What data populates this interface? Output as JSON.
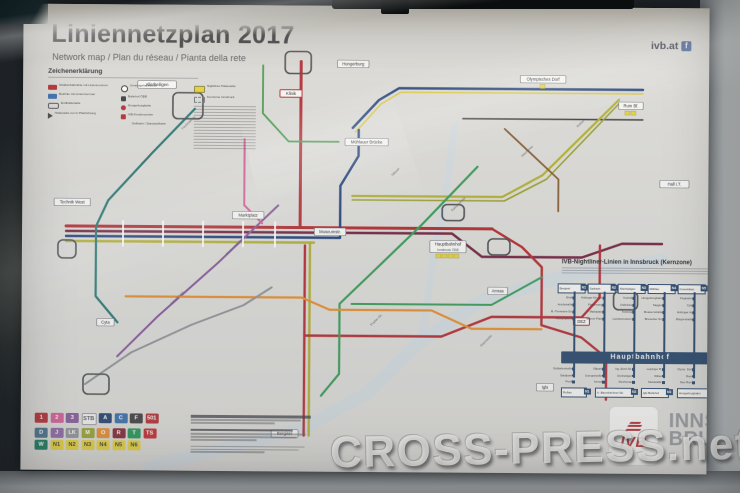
{
  "header": {
    "title": "Liniennetzplan 2017",
    "subtitle": "Network map / Plan du réseau / Pianta della rete",
    "site": "ivb.at",
    "facebook_label": "f"
  },
  "legend": {
    "title": "Zeichenerklärung",
    "columns": [
      [
        {
          "icon": "tram",
          "label": "Straßenbahnlinie mit Liniennummer"
        },
        {
          "icon": "bus",
          "label": "Buslinie mit Liniennummer"
        },
        {
          "icon": "loop",
          "label": "Endhaltestelle"
        },
        {
          "icon": "arrow",
          "label": "Haltestelle nur in Pfeilrichtung"
        }
      ],
      [
        {
          "icon": "hub",
          "label": "Umsteigehaltestelle"
        },
        {
          "icon": "rail",
          "label": "Bahnhof ÖBB"
        },
        {
          "icon": "funicular",
          "label": "Hungerburgbahn"
        },
        {
          "icon": "center",
          "label": "IVB-Kundencenter"
        },
        {
          "icon": "cable",
          "label": "Seilbahn / Standseilbahn"
        }
      ],
      [
        {
          "icon": "night",
          "label": "Nightliner-Haltestelle"
        },
        {
          "icon": "zone",
          "label": "Kernzone Innsbruck"
        }
      ]
    ]
  },
  "badge_grid": {
    "rows": [
      [
        {
          "t": "1",
          "bg": "#c0272d"
        },
        {
          "t": "2",
          "bg": "#e0589a"
        },
        {
          "t": "3",
          "bg": "#8a56a0"
        },
        {
          "t": "STB",
          "bg": "#f3f2ef",
          "fg": "#55555a",
          "border": true
        },
        {
          "t": "A",
          "bg": "#1d3f73"
        },
        {
          "t": "C",
          "bg": "#2f6db5"
        },
        {
          "t": "F",
          "bg": "#3d3d3f"
        },
        {
          "t": "501",
          "bg": "#c0272d"
        }
      ],
      [
        {
          "t": "D",
          "bg": "#3f6e8c"
        },
        {
          "t": "J",
          "bg": "#9064a8"
        },
        {
          "t": "LK",
          "bg": "#8f9398"
        },
        {
          "t": "M",
          "bg": "#97a31f"
        },
        {
          "t": "O",
          "bg": "#ef8b1f"
        },
        {
          "t": "R",
          "bg": "#8e2030"
        },
        {
          "t": "T",
          "bg": "#129a4e"
        },
        {
          "t": "TS",
          "bg": "#d2232a"
        }
      ],
      [
        {
          "t": "W",
          "bg": "#0a7a5a"
        },
        {
          "t": "N1",
          "bg": "#ead423",
          "fg": "#3a3a30"
        },
        {
          "t": "N2",
          "bg": "#ead423",
          "fg": "#3a3a30"
        },
        {
          "t": "N3",
          "bg": "#ead423",
          "fg": "#3a3a30"
        },
        {
          "t": "N4",
          "bg": "#ead423",
          "fg": "#3a3a30"
        },
        {
          "t": "N5",
          "bg": "#ead423",
          "fg": "#3a3a30"
        },
        {
          "t": "N6",
          "bg": "#ead423",
          "fg": "#3a3a30"
        }
      ]
    ]
  },
  "map": {
    "badge_color": "#ead423",
    "river": [
      {
        "c": "#c7dbe9",
        "w": 13,
        "o": 0.5,
        "pts": [
          [
            130,
            462
          ],
          [
            280,
            424
          ],
          [
            345,
            388
          ],
          [
            400,
            334
          ],
          [
            460,
            294
          ],
          [
            545,
            268
          ],
          [
            640,
            252
          ]
        ]
      },
      {
        "c": "#c7dbe9",
        "w": 7,
        "o": 0.45,
        "pts": [
          [
            400,
            334
          ],
          [
            412,
            250
          ],
          [
            425,
            175
          ],
          [
            432,
            120
          ]
        ]
      }
    ],
    "lines": [
      {
        "c": "#1c3f7e",
        "w": 2.4,
        "pts": [
          [
            330,
            122
          ],
          [
            356,
            94
          ],
          [
            376,
            82
          ],
          [
            620,
            82
          ]
        ]
      },
      {
        "c": "#ddc928",
        "w": 1.6,
        "pts": [
          [
            333,
            126
          ],
          [
            358,
            98
          ],
          [
            378,
            86
          ],
          [
            620,
            86
          ]
        ]
      },
      {
        "c": "#3a3a3a",
        "w": 1.4,
        "pts": [
          [
            440,
            112
          ],
          [
            620,
            112
          ]
        ]
      },
      {
        "c": "#c0272d",
        "w": 3,
        "pts": [
          [
            278,
            56
          ],
          [
            278,
            150
          ],
          [
            278,
            222
          ]
        ]
      },
      {
        "c": "#c0272d",
        "w": 3,
        "pts": [
          [
            44,
            222
          ],
          [
            470,
            222
          ]
        ]
      },
      {
        "c": "#7a2040",
        "w": 2.4,
        "pts": [
          [
            44,
            227
          ],
          [
            430,
            227
          ],
          [
            460,
            250
          ],
          [
            560,
            250
          ],
          [
            600,
            236
          ],
          [
            640,
            236
          ]
        ]
      },
      {
        "c": "#1c3f7e",
        "w": 2.4,
        "pts": [
          [
            44,
            232
          ],
          [
            318,
            232
          ],
          [
            318,
            180
          ],
          [
            336,
            150
          ],
          [
            336,
            124
          ]
        ]
      },
      {
        "c": "#b3b021",
        "w": 2.4,
        "pts": [
          [
            44,
            237
          ],
          [
            292,
            237
          ]
        ]
      },
      {
        "c": "#b3b021",
        "w": 2.4,
        "pts": [
          [
            288,
            237
          ],
          [
            288,
            430
          ]
        ]
      },
      {
        "c": "#c0272d",
        "w": 2.4,
        "pts": [
          [
            283,
            240
          ],
          [
            283,
            430
          ]
        ]
      },
      {
        "c": "#c0272d",
        "w": 2.4,
        "pts": [
          [
            470,
            222
          ],
          [
            500,
            240
          ],
          [
            520,
            260
          ],
          [
            520,
            318
          ],
          [
            560,
            330
          ],
          [
            585,
            350
          ],
          [
            585,
            392
          ]
        ]
      },
      {
        "c": "#c0272d",
        "w": 2.4,
        "pts": [
          [
            283,
            330
          ],
          [
            420,
            330
          ],
          [
            470,
            310
          ],
          [
            560,
            310
          ],
          [
            578,
            290
          ],
          [
            578,
            238
          ]
        ]
      },
      {
        "c": "#b3b021",
        "w": 2.2,
        "pts": [
          [
            596,
            92
          ],
          [
            520,
            168
          ],
          [
            480,
            190
          ],
          [
            330,
            190
          ]
        ]
      },
      {
        "c": "#9aa11c",
        "w": 1.6,
        "pts": [
          [
            596,
            96
          ],
          [
            524,
            172
          ],
          [
            482,
            194
          ],
          [
            330,
            194
          ]
        ]
      },
      {
        "c": "#2e9e4f",
        "w": 2.2,
        "pts": [
          [
            455,
            160
          ],
          [
            400,
            218
          ],
          [
            355,
            262
          ],
          [
            318,
            298
          ],
          [
            318,
            368
          ],
          [
            300,
            390
          ]
        ]
      },
      {
        "c": "#2e9e4f",
        "w": 2,
        "pts": [
          [
            330,
            298
          ],
          [
            470,
            298
          ],
          [
            520,
            270
          ]
        ]
      },
      {
        "c": "#1f7a74",
        "w": 2.2,
        "pts": [
          [
            172,
            104
          ],
          [
            130,
            148
          ],
          [
            86,
            196
          ],
          [
            74,
            222
          ],
          [
            74,
            292
          ],
          [
            96,
            318
          ]
        ]
      },
      {
        "c": "#8a56a0",
        "w": 2,
        "pts": [
          [
            256,
            200
          ],
          [
            196,
            258
          ],
          [
            136,
            312
          ],
          [
            96,
            352
          ]
        ]
      },
      {
        "c": "#e0589a",
        "w": 2,
        "pts": [
          [
            222,
            134
          ],
          [
            222,
            200
          ],
          [
            240,
            218
          ]
        ]
      },
      {
        "c": "#ef8b1f",
        "w": 2.2,
        "pts": [
          [
            104,
            292
          ],
          [
            280,
            292
          ],
          [
            308,
            304
          ],
          [
            410,
            304
          ],
          [
            450,
            322
          ],
          [
            520,
            322
          ]
        ]
      },
      {
        "c": "#8a5a28",
        "w": 1.8,
        "pts": [
          [
            482,
            122
          ],
          [
            536,
            172
          ],
          [
            536,
            204
          ]
        ]
      },
      {
        "c": "#8f9398",
        "w": 2,
        "pts": [
          [
            64,
            380
          ],
          [
            110,
            348
          ],
          [
            170,
            320
          ],
          [
            222,
            300
          ],
          [
            250,
            282
          ]
        ]
      },
      {
        "c": "#3f9c46",
        "w": 1.8,
        "pts": [
          [
            240,
            60
          ],
          [
            240,
            108
          ],
          [
            266,
            136
          ],
          [
            316,
            136
          ]
        ]
      }
    ],
    "loops": [
      [
        150,
        88,
        30,
        26
      ],
      [
        262,
        46,
        26,
        22
      ],
      [
        36,
        236,
        18,
        18
      ],
      [
        592,
        284,
        24,
        18
      ],
      [
        62,
        370,
        26,
        20
      ],
      [
        420,
        198,
        22,
        16
      ],
      [
        466,
        232,
        22,
        16
      ]
    ],
    "ticks": [
      [
        100,
        216,
        2,
        26
      ],
      [
        140,
        216,
        2,
        26
      ],
      [
        180,
        216,
        2,
        26
      ],
      [
        220,
        216,
        2,
        26
      ],
      [
        252,
        216,
        2,
        26
      ]
    ],
    "labels": [
      {
        "x": 426,
        "y": 240,
        "t": "Hauptbahnhof",
        "sub": "Innsbruck ÖBB",
        "badges": 4
      },
      {
        "x": 226,
        "y": 210,
        "t": "Marktplatz"
      },
      {
        "x": 268,
        "y": 88,
        "t": "Klinik",
        "red": true
      },
      {
        "x": 134,
        "y": 80,
        "t": "Allerheiligen"
      },
      {
        "x": 50,
        "y": 198,
        "t": "Technik West"
      },
      {
        "x": 344,
        "y": 136,
        "t": "Mühlauer Brücke"
      },
      {
        "x": 520,
        "y": 72,
        "t": "Olympisches Dorf",
        "badges": 1
      },
      {
        "x": 608,
        "y": 98,
        "t": "Rum Bf.",
        "badges": 2
      },
      {
        "x": 476,
        "y": 284,
        "t": "Amras"
      },
      {
        "x": 560,
        "y": 314,
        "t": "DEZ",
        "red": true
      },
      {
        "x": 524,
        "y": 380,
        "t": "Igls"
      },
      {
        "x": 264,
        "y": 428,
        "t": "Bergisel"
      },
      {
        "x": 84,
        "y": 318,
        "t": "Cyta"
      },
      {
        "x": 652,
        "y": 176,
        "t": "Hall i.T."
      },
      {
        "x": 330,
        "y": 58,
        "t": "Hungerburg"
      },
      {
        "x": 308,
        "y": 226,
        "t": "Museumstr."
      }
    ],
    "rlabels": [
      {
        "x": 120,
        "y": 160,
        "t": "Sadrach"
      },
      {
        "x": 160,
        "y": 125,
        "t": "Fischnalerstr."
      },
      {
        "x": 205,
        "y": 250,
        "t": "Klosterangerle"
      },
      {
        "x": 370,
        "y": 170,
        "t": "Sillpark"
      },
      {
        "x": 430,
        "y": 205,
        "t": "Gumppstraße"
      },
      {
        "x": 500,
        "y": 150,
        "t": "Reichenau"
      },
      {
        "x": 555,
        "y": 120,
        "t": "Roßau"
      },
      {
        "x": 350,
        "y": 320,
        "t": "Pradler Str."
      },
      {
        "x": 150,
        "y": 300,
        "t": "Schießstand"
      },
      {
        "x": 460,
        "y": 340,
        "t": "Geyrstraße"
      }
    ]
  },
  "nightliner": {
    "title": "IVB-Nightliner-Linien in Innsbruck (Kernzone)",
    "hub": "Hauptbahnhof",
    "columns": [
      {
        "terminal": "Bergisel",
        "badge": "N1",
        "above": [
          "Klinik",
          "Anichstraße",
          "M.-Theresien-Str.",
          "Triumphpforte"
        ],
        "below": [
          "Südbahnstraße",
          "Stadtpark",
          "Pradl"
        ]
      },
      {
        "terminal": "Sadrach",
        "badge": "N2",
        "above": [
          "Höttinger Kirchpl.",
          "Fürstenweg",
          "Marktplatz",
          "Bozner Platz"
        ],
        "below": [
          "Sillpark",
          "Gumppstraße",
          "Amras"
        ]
      },
      {
        "terminal": "Allerheiligen",
        "badge": "N3",
        "above": [
          "Technik",
          "Unibrücke",
          "Terminal",
          "Landesmuseum"
        ],
        "below": [
          "Ing.-Etzel-Str.",
          "Dreiheiligen",
          "Reichenau"
        ]
      },
      {
        "terminal": "Mühlau",
        "badge": "N4",
        "above": [
          "Hungerburgbahn",
          "Saggen",
          "Museumstraße",
          "Brunecker Str."
        ],
        "below": [
          "Leipziger Pl.",
          "Wilten",
          "Stubaitalbf."
        ]
      },
      {
        "terminal": "Kranebitten",
        "badge": "N5",
        "above": [
          "Flughafen",
          "Cyta",
          "Höttinger Au",
          "Bürgerstraße"
        ],
        "below": [
          "Olymp. Dorf",
          "Rum",
          "Neu-Rum"
        ]
      }
    ],
    "bottom_terminals": [
      {
        "name": "Roßau",
        "badge": "N1"
      },
      {
        "name": "A.-Baumkirchner-Str.",
        "badge": "N2"
      },
      {
        "name": "Igls Bahnhof",
        "badge": "N3"
      },
      {
        "name": "Hungerburgbahn",
        "badge": "N4"
      }
    ]
  },
  "logos": {
    "ivb": "IVB",
    "city_line1": "INNS'",
    "city_line2": "BRUCK"
  },
  "watermark": "CROSS-PRESS.net"
}
